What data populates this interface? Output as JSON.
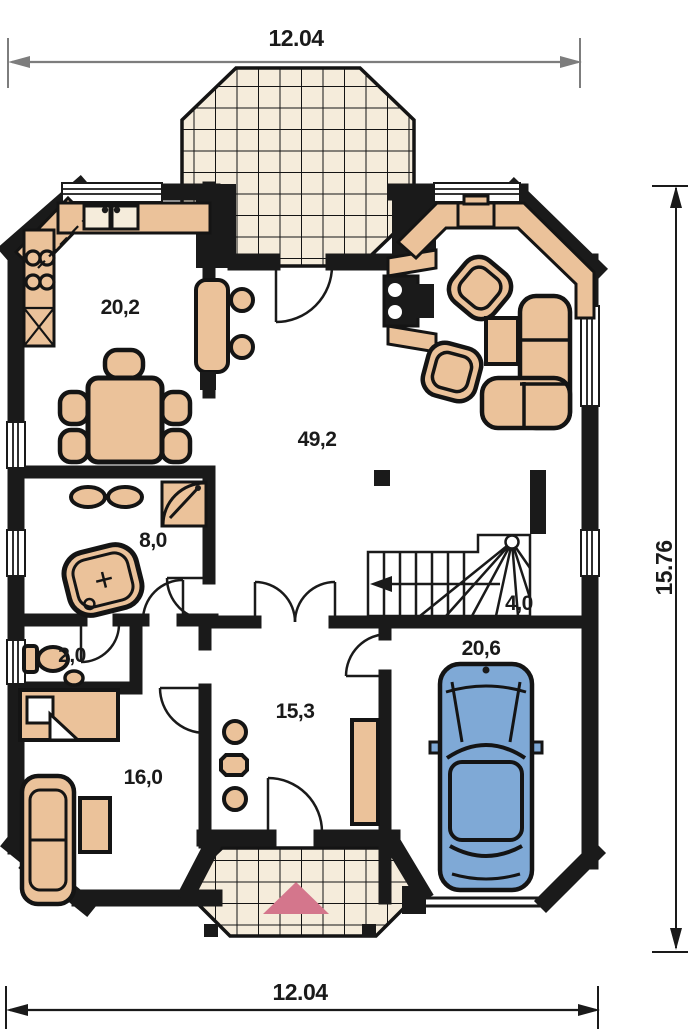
{
  "plan": {
    "title": "house floor plan",
    "dimension_labels": {
      "top": "12.04",
      "bottom": "12.04",
      "right": "15.76"
    },
    "room_areas": {
      "kitchen_dining": "20,2",
      "main_living": "49,2",
      "bathroom": "8,0",
      "stairs": "4,0",
      "wc": "2,0",
      "garage": "20,6",
      "entrance_hall": "15,3",
      "room": "16,0"
    },
    "colors": {
      "wall": "#1a1a1a",
      "furniture": "#ebc29a",
      "tile": "#f5ecdb",
      "car": "#7fa9d6",
      "entrance_marker": "#d4768c",
      "dimension_top": "#7d7d7d",
      "dimension_main": "#1a1a1a"
    }
  }
}
